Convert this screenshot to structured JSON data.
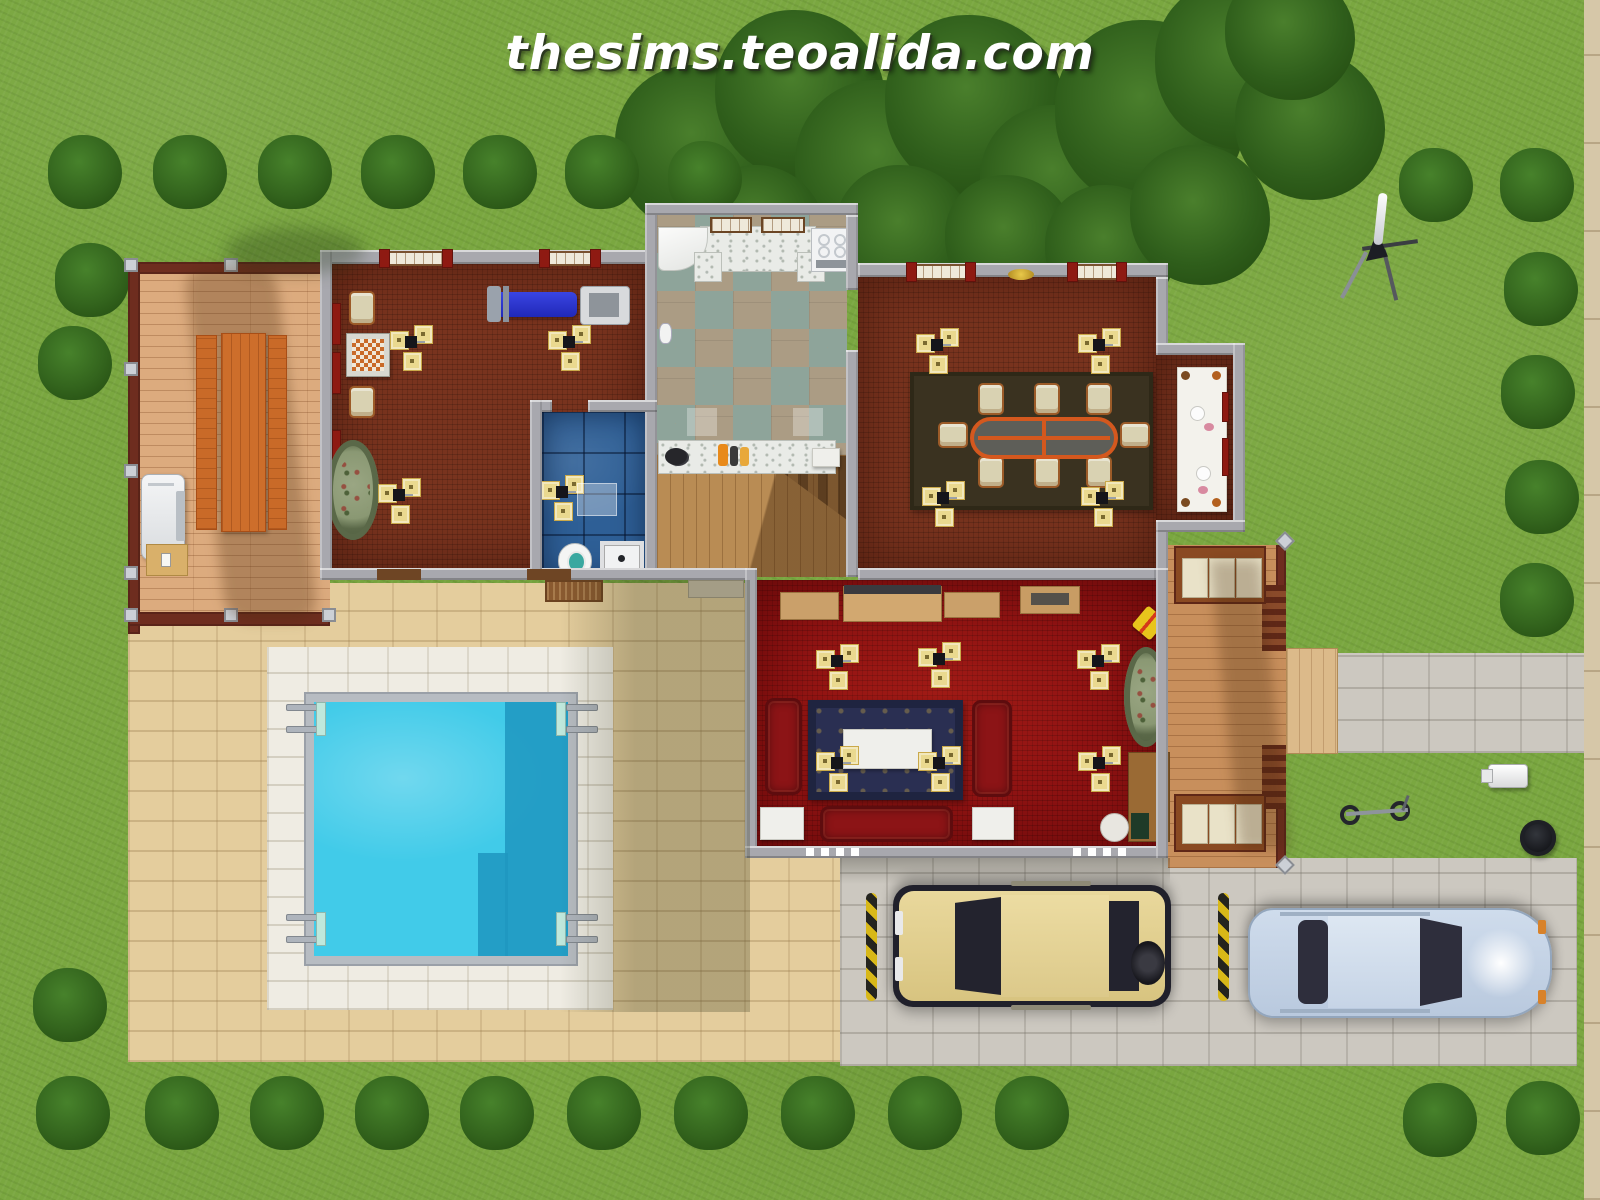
{
  "watermark": {
    "text": "thesims.teoalida.com"
  },
  "scene": {
    "description": "top-down floor plan render of a house lot",
    "visible_objects": [
      "lawn",
      "hedge bushes",
      "tree canopy",
      "wooden deck",
      "picnic table",
      "barbecue grill",
      "game room",
      "chess table",
      "exercise bench",
      "treadmill",
      "bathroom",
      "toilet",
      "shower",
      "kitchen",
      "stove",
      "marble counters",
      "hallway",
      "staircase",
      "dining room",
      "dining table",
      "dining chairs",
      "buffet table",
      "living room",
      "red sofas",
      "coffee table",
      "patterned rug",
      "oval rug",
      "desk",
      "stool",
      "toy xylophone",
      "ceiling lamps",
      "swimming pool",
      "pool ladders",
      "stone patio",
      "right porch",
      "porch benches",
      "footpath",
      "driveway",
      "yellow suv",
      "blue sedan",
      "parking stoppers",
      "telescope",
      "bicycle",
      "mailbox",
      "trash can",
      "sidewalk"
    ]
  },
  "colors": {
    "grass": "#7aa740",
    "bushGreen": "#2f5e1b",
    "wall": "#a8a8ae",
    "carpetBrown": "#78331e",
    "carpetRed": "#8e1212",
    "kitchenTileA": "#ab9c84",
    "kitchenTileB": "#8ea49a",
    "bathTile": "#2e5f96",
    "marble": "#e9ebe7",
    "deckWood": "#dcab7e",
    "hallWood": "#b98c54",
    "porchWood": "#c88f5c",
    "pavingTan": "#e4cd9d",
    "pavingWhite": "#efece3",
    "driveway": "#ccc8c0",
    "poolWater": "#41cbe9",
    "poolShadow": "#1f96c0",
    "lampYellow": "#ead98f",
    "curtainRed": "#8e1a12",
    "sofaRed": "#8c1416",
    "tableOrange": "#d4581e",
    "carYellow": "#e0cd90",
    "carBlue": "#c9d8ea"
  }
}
